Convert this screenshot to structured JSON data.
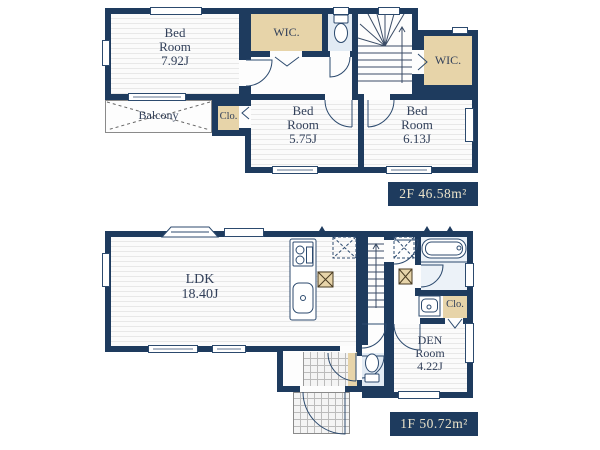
{
  "doc_title": "floor-plan",
  "colors": {
    "wall": "#1e3b5e",
    "closet_tan": "#e7d4a9",
    "wet_blue": "#e2ebf4",
    "label_bg": "#1e3b5e",
    "label_text": "#ece4cb"
  },
  "floor2": {
    "bedroom1": {
      "lines": [
        "Bed",
        "Room",
        "7.92J"
      ]
    },
    "wic_top": {
      "label": "WIC."
    },
    "wic_right": {
      "label": "WIC."
    },
    "balcony": {
      "label": "Balcony"
    },
    "closet": {
      "label": "Clo."
    },
    "bedroom2": {
      "lines": [
        "Bed",
        "Room",
        "5.75J"
      ]
    },
    "bedroom3": {
      "lines": [
        "Bed",
        "Room",
        "6.13J"
      ]
    },
    "area_label": "2F 46.58m²"
  },
  "floor1": {
    "ldk": {
      "lines": [
        "LDK",
        "18.40J"
      ]
    },
    "closet": {
      "label": "Clo."
    },
    "den": {
      "lines": [
        "DEN",
        "Room",
        "4.22J"
      ]
    },
    "area_label": "1F 50.72m²"
  }
}
